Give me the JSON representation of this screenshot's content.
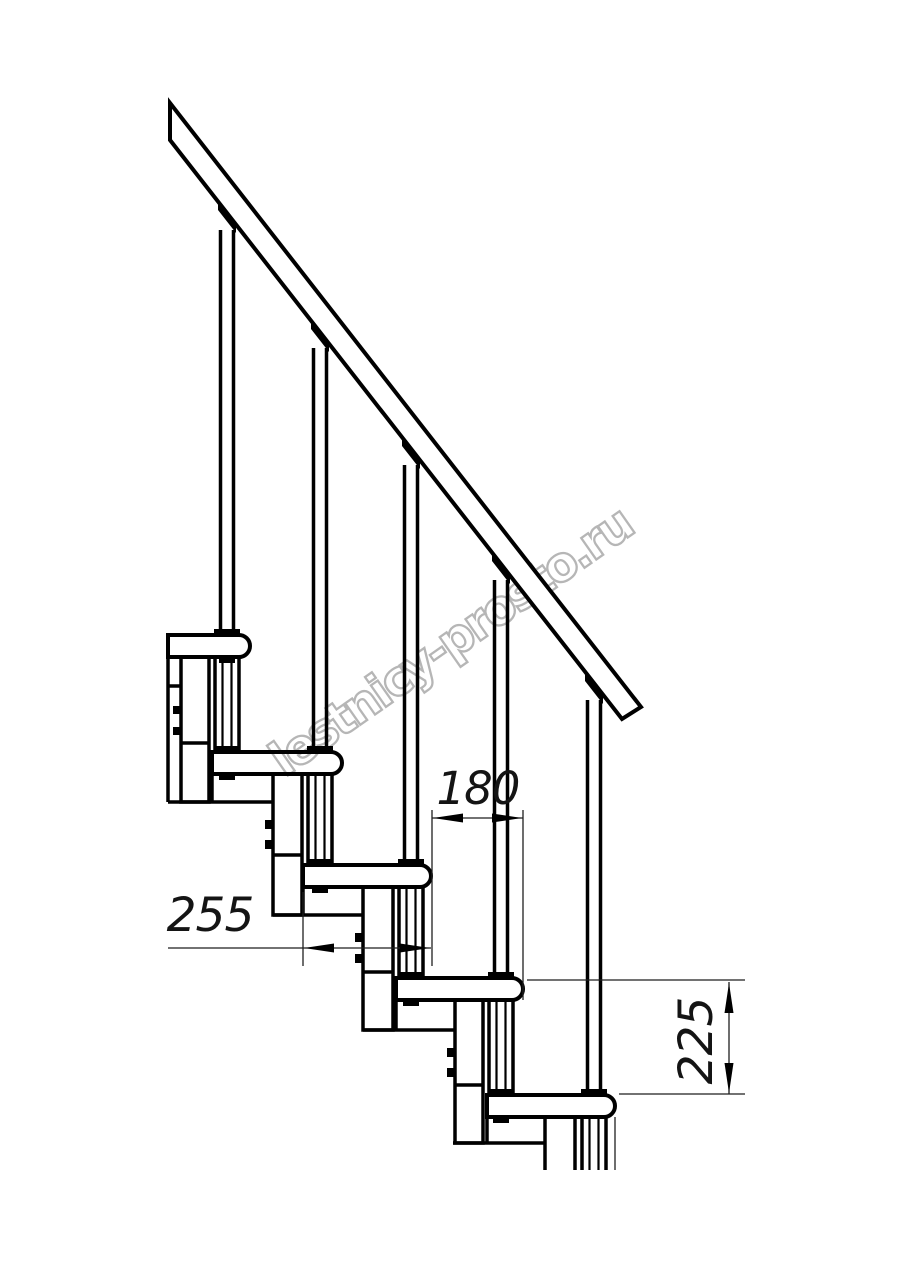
{
  "drawing": {
    "title": "Staircase side-section technical drawing",
    "watermark": "lestnicy-prosto.ru",
    "dimensions": {
      "step_run_mm": "180",
      "tread_length_mm": "255",
      "step_rise_mm": "225"
    },
    "structure": {
      "tread_count": 5,
      "baluster_count": 5,
      "has_handrail": true
    },
    "colors": {
      "line": "#000000",
      "dimension": "#1f1f1f",
      "watermark": "#b6b6b6",
      "background": "#ffffff"
    }
  }
}
